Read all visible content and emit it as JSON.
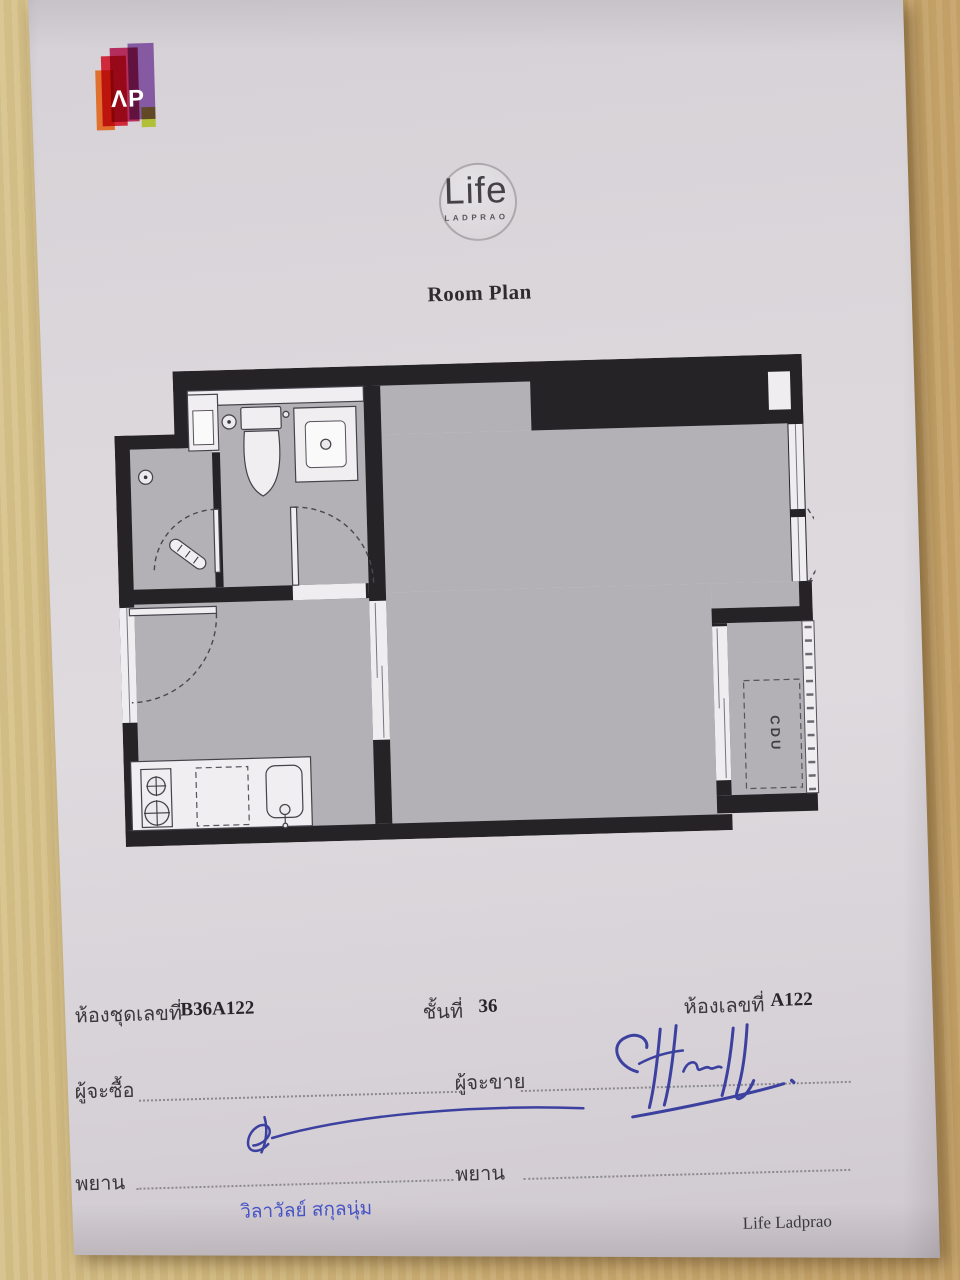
{
  "branding": {
    "ap_logo_text": "ΛP",
    "ap_colors": {
      "orange": "#e2671f",
      "red": "#cf1a2e",
      "magenta": "#b01e52",
      "purple": "#7e4f9e",
      "green": "#aebe2a"
    },
    "life_name": "Life",
    "life_subtitle": "LADPRAO"
  },
  "title": "Room Plan",
  "plan": {
    "cdu_label": "CDU"
  },
  "details": {
    "unit_label": "ห้องชุดเลขที่",
    "unit_value": "B36A122",
    "floor_label": "ชั้นที่",
    "floor_value": "36",
    "room_label": "ห้องเลขที่",
    "room_value": "A122"
  },
  "signatures": {
    "buyer_label": "ผู้จะซื้อ",
    "seller_label": "ผู้จะขาย",
    "witness_left_label": "พยาน",
    "witness_right_label": "พยาน",
    "witness_name": "วิลาวัลย์ สกุลนุ่ม"
  },
  "footer": "Life Ladprao",
  "colors": {
    "paper": "#dad6da",
    "wall": "#262327",
    "floor": "#b3b0b6",
    "wood_light": "#d8c48d",
    "wood_dark": "#c5a268",
    "ink_blue": "#3c41a0",
    "fixture": "#f0eef1"
  }
}
